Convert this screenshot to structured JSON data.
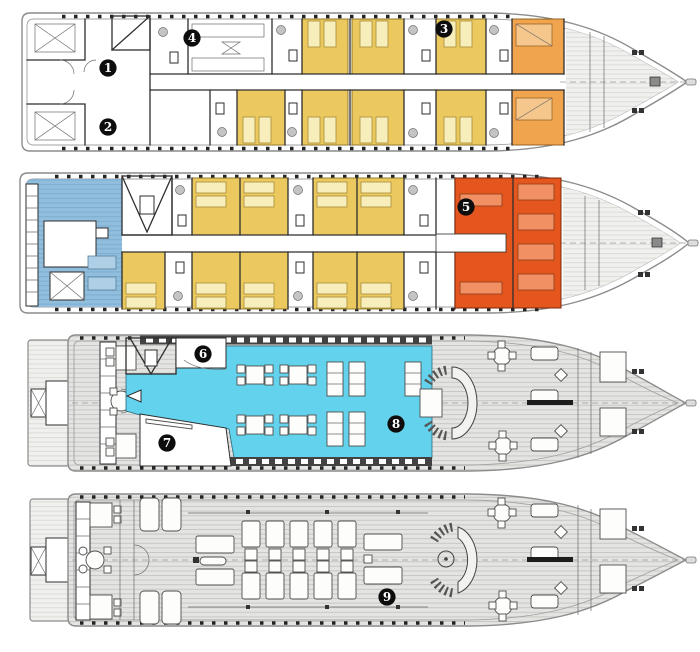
{
  "figure": {
    "type": "ship-deck-plan",
    "deck_count": 4,
    "marker_count": 9
  },
  "markers": [
    {
      "label": "1",
      "pos": "translate(108,68)"
    },
    {
      "label": "2",
      "pos": "translate(108,127)"
    },
    {
      "label": "3",
      "pos": "translate(444,29)"
    },
    {
      "label": "4",
      "pos": "translate(192,38)"
    },
    {
      "label": "5",
      "pos": "translate(466,207)"
    },
    {
      "label": "6",
      "pos": "translate(203,354)"
    },
    {
      "label": "7",
      "pos": "translate(167,443)"
    },
    {
      "label": "8",
      "pos": "translate(396,424)"
    },
    {
      "label": "9",
      "pos": "translate(387,597)"
    }
  ],
  "colors": {
    "cabin_yellow": "#ecc95f",
    "cabin_orange": "#f0a44e",
    "suite_red": "#e4561e",
    "lounge_blue": "#92bedd",
    "dining_cyan": "#63d2ec",
    "deck_gray": "#e4e4e2",
    "deck_gray_light": "#f0f0ee",
    "superstructure_dark": "#424242",
    "marker_bg": "#0d0d0d",
    "marker_text": "#ffffff"
  }
}
